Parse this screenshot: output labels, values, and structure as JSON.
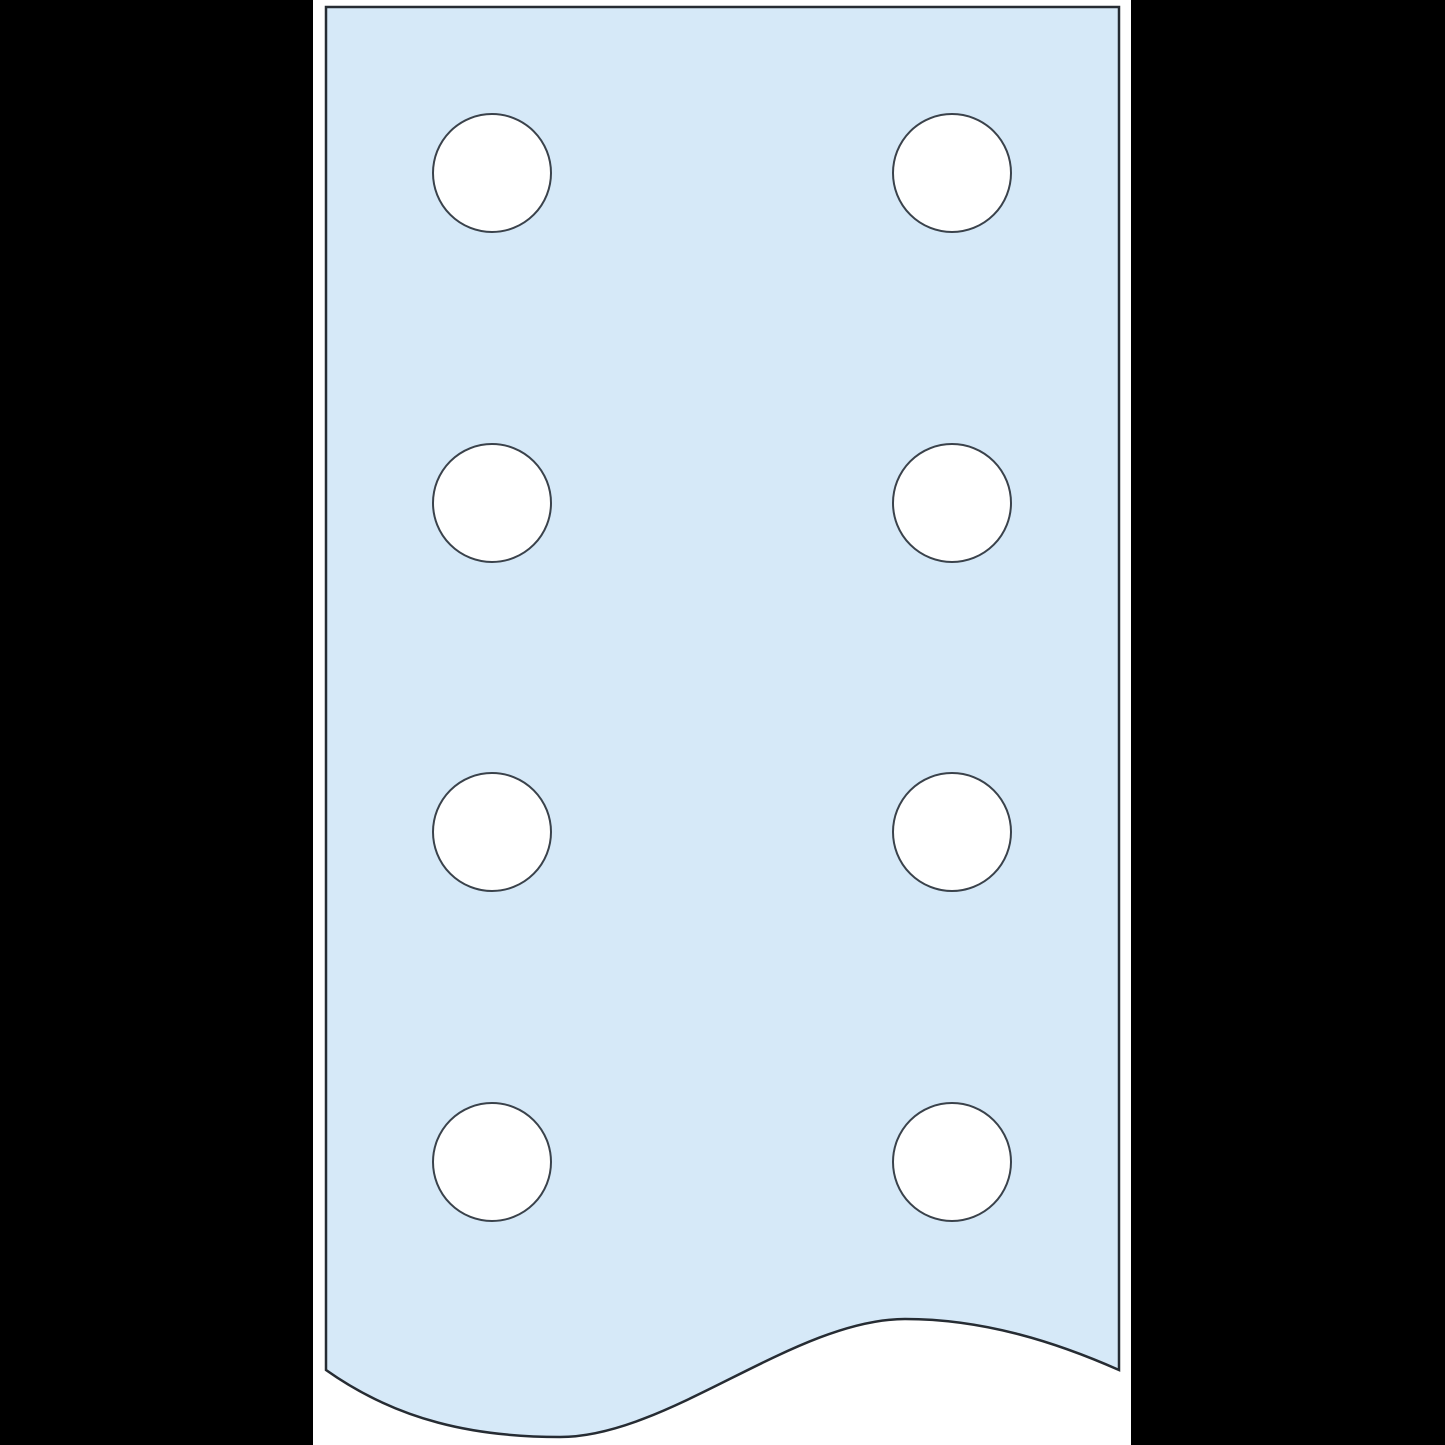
{
  "figure": {
    "description": "Perforated flat plate segment shown with two columns of four round holes and a wavy break line at the bottom edge",
    "hole_count": 8,
    "hole_grid": {
      "rows": 4,
      "columns": 2
    },
    "hole_radius": 59,
    "holes": [
      {
        "cx": 492,
        "cy": 173
      },
      {
        "cx": 952,
        "cy": 173
      },
      {
        "cx": 492,
        "cy": 503
      },
      {
        "cx": 952,
        "cy": 503
      },
      {
        "cx": 492,
        "cy": 832
      },
      {
        "cx": 952,
        "cy": 832
      },
      {
        "cx": 492,
        "cy": 1162
      },
      {
        "cx": 952,
        "cy": 1162
      }
    ],
    "canvas_strip": {
      "left": 313,
      "width": 818
    },
    "colors": {
      "background": "#000000",
      "canvas": "#ffffff",
      "plate_fill": "#d6e9f8",
      "plate_stroke": "#262c33",
      "hole_fill": "#ffffff",
      "hole_stroke": "#3a424b"
    },
    "stroke_widths": {
      "plate": 2.5,
      "hole": 2
    }
  }
}
